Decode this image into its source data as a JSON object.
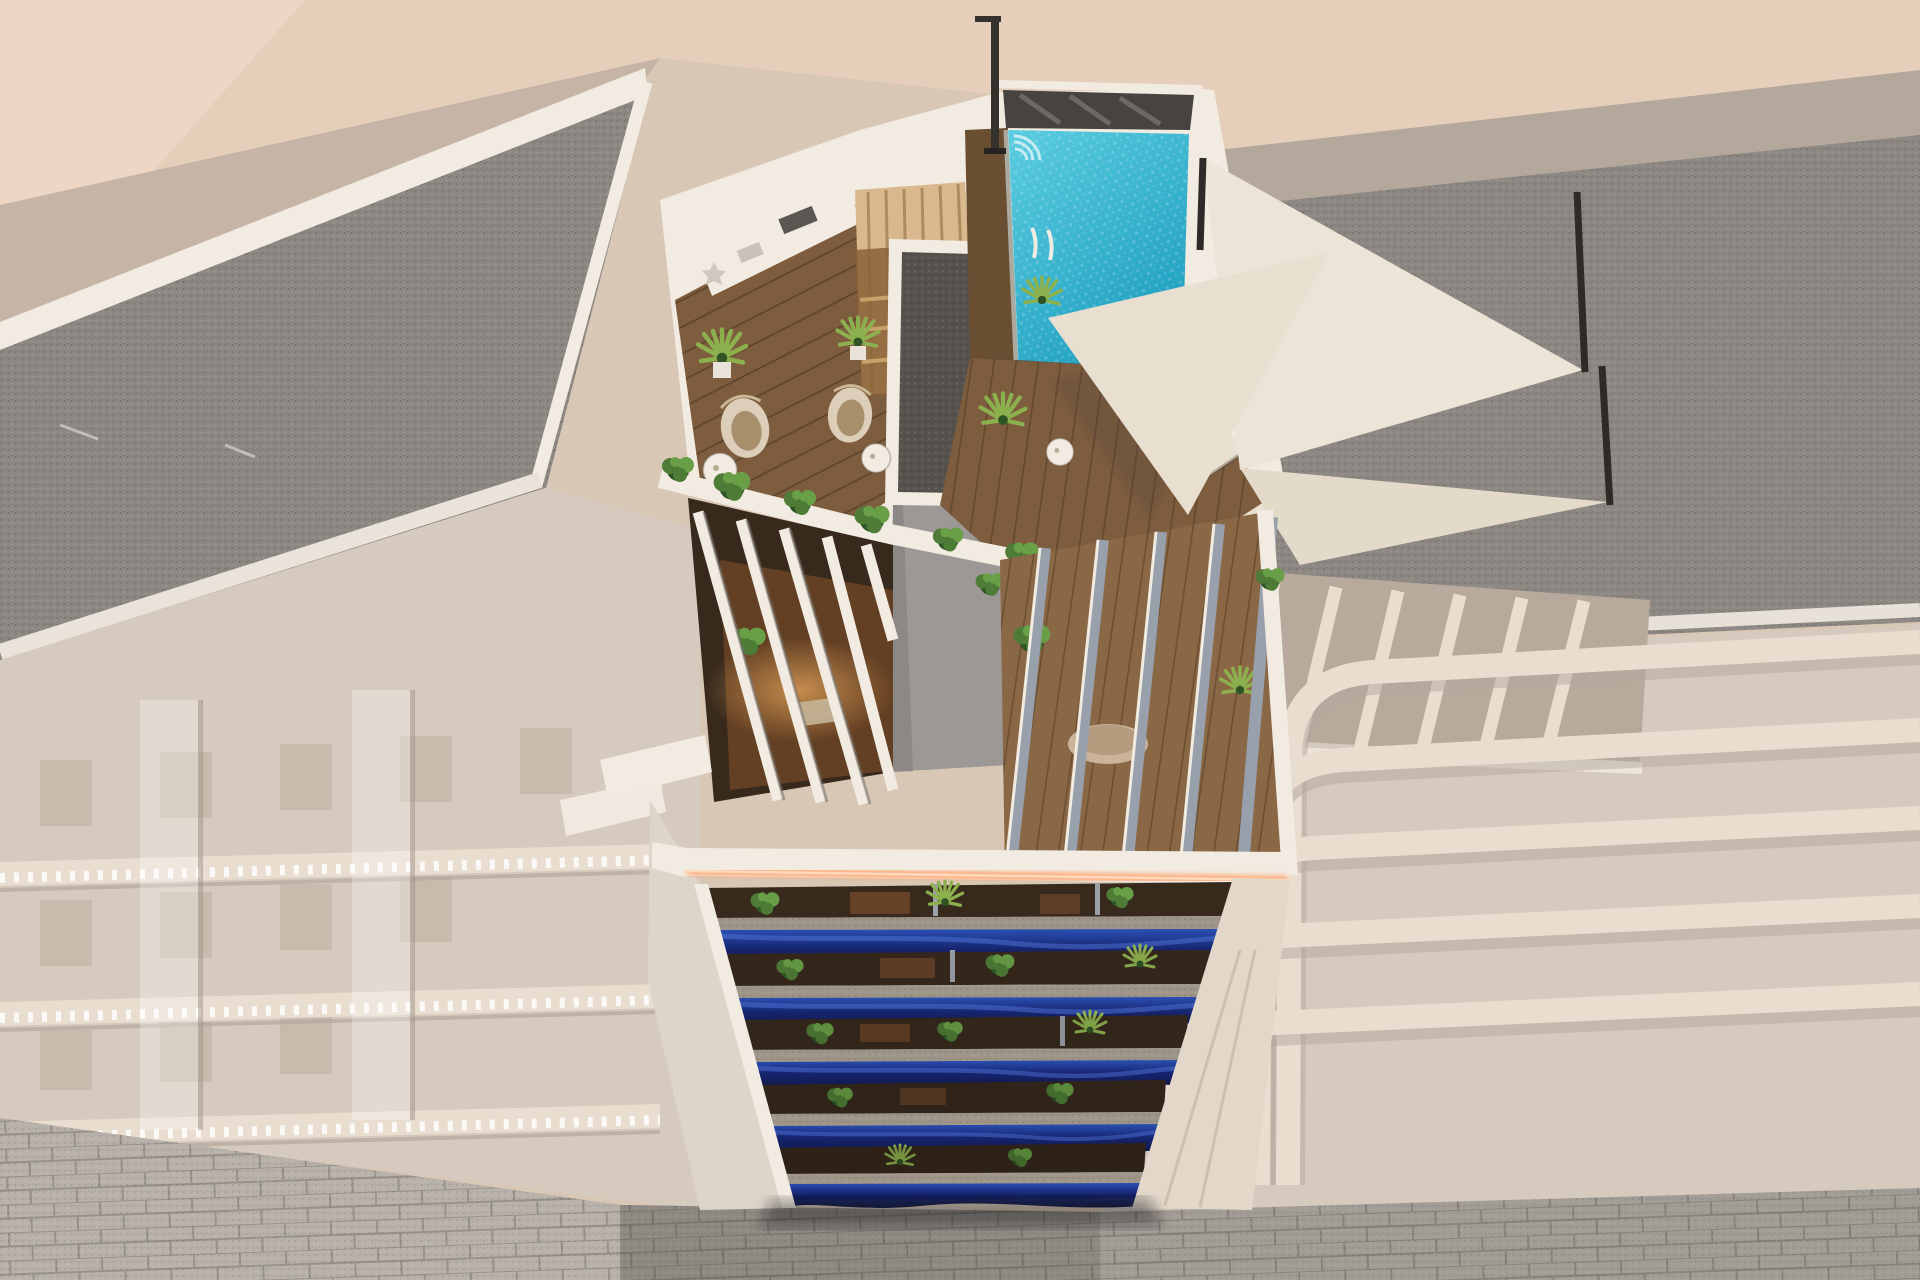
{
  "meta": {
    "type": "architectural-3d-render",
    "view": "aerial-drone-view",
    "description": "New-build apartment tower in full colour between ghosted white neighbouring buildings; rooftop pool terrace, pergola attico level, five floors of wavy royal-blue balconies, paved street below."
  },
  "palette": {
    "bg_beige": "#d9c7b6",
    "pink_roof": "#eed6c5",
    "tan_strip": "#e6cfba",
    "ghost_wall": "#d6c9be",
    "ghost_shadow": "#b4a79b",
    "ghost_band": "#e9ddd0",
    "gravel": "#8d8883",
    "gravel_dark": "#56524e",
    "parapet_white": "#f2ebe2",
    "white_shadow": "#ddd5ca",
    "core_grey": "#9c9895",
    "glass_dark": "#474340",
    "pool_light": "#5bcde0",
    "pool_deep": "#1f9fc0",
    "deck_wood": "#7d5d3e",
    "deck_wood_dark": "#6a4e31",
    "sauna_wood": "#d8b88c",
    "sauna_dark": "#8a6136",
    "sail": "#ece4d6",
    "lounger": "#e9e0d2",
    "bush_green": "#4e7c36",
    "bush_light": "#699f47",
    "bush_dark": "#2f5527",
    "palm_green": "#8db04e",
    "balcony_blue": "#16246e",
    "balcony_blue_light": "#2b50b4",
    "balcony_blue_dark": "#0e1744",
    "balcony_highlight": "#4f74d8",
    "ledge_speckle": "#9f968a",
    "interior_dark": "#38291d",
    "interior_warm": "#8a5630",
    "led_glow": "#ff9e63",
    "led_core": "#ffd9bd",
    "street": "#a39d97",
    "street_light": "#b8b2ab",
    "street_dark": "#8f8a84",
    "shadow": "#2a241f"
  },
  "scene": {
    "main_building": {
      "label": "main-apartment-building",
      "balcony_floors": 5,
      "rooftop_features": [
        "swimming-pool",
        "glass-pool-fence",
        "outdoor-shower",
        "wood-sun-deck",
        "sauna-cabin",
        "outdoor-kitchen-counter",
        "shade-sails",
        "sun-loungers",
        "hanging-egg-chairs",
        "bistro-tables",
        "potted-palms",
        "hedge-planters",
        "stair-core-with-gravel-roof"
      ],
      "attico_features": [
        "pergola-slats-left-terrace",
        "pergola-slats-right-terrace",
        "round-table",
        "led-strip-fascia"
      ],
      "balcony_features": [
        "wavy-royal-blue-fronts",
        "speckled-stone-ledges",
        "balcony-plants",
        "warm-interiors"
      ]
    },
    "context": {
      "left_building": "ghosted-building-gravel-roof-balustrade-balconies",
      "right_building": "ghosted-building-gravel-roof-curved-balconies-pergola",
      "street": "grey-block-paved-street"
    }
  }
}
